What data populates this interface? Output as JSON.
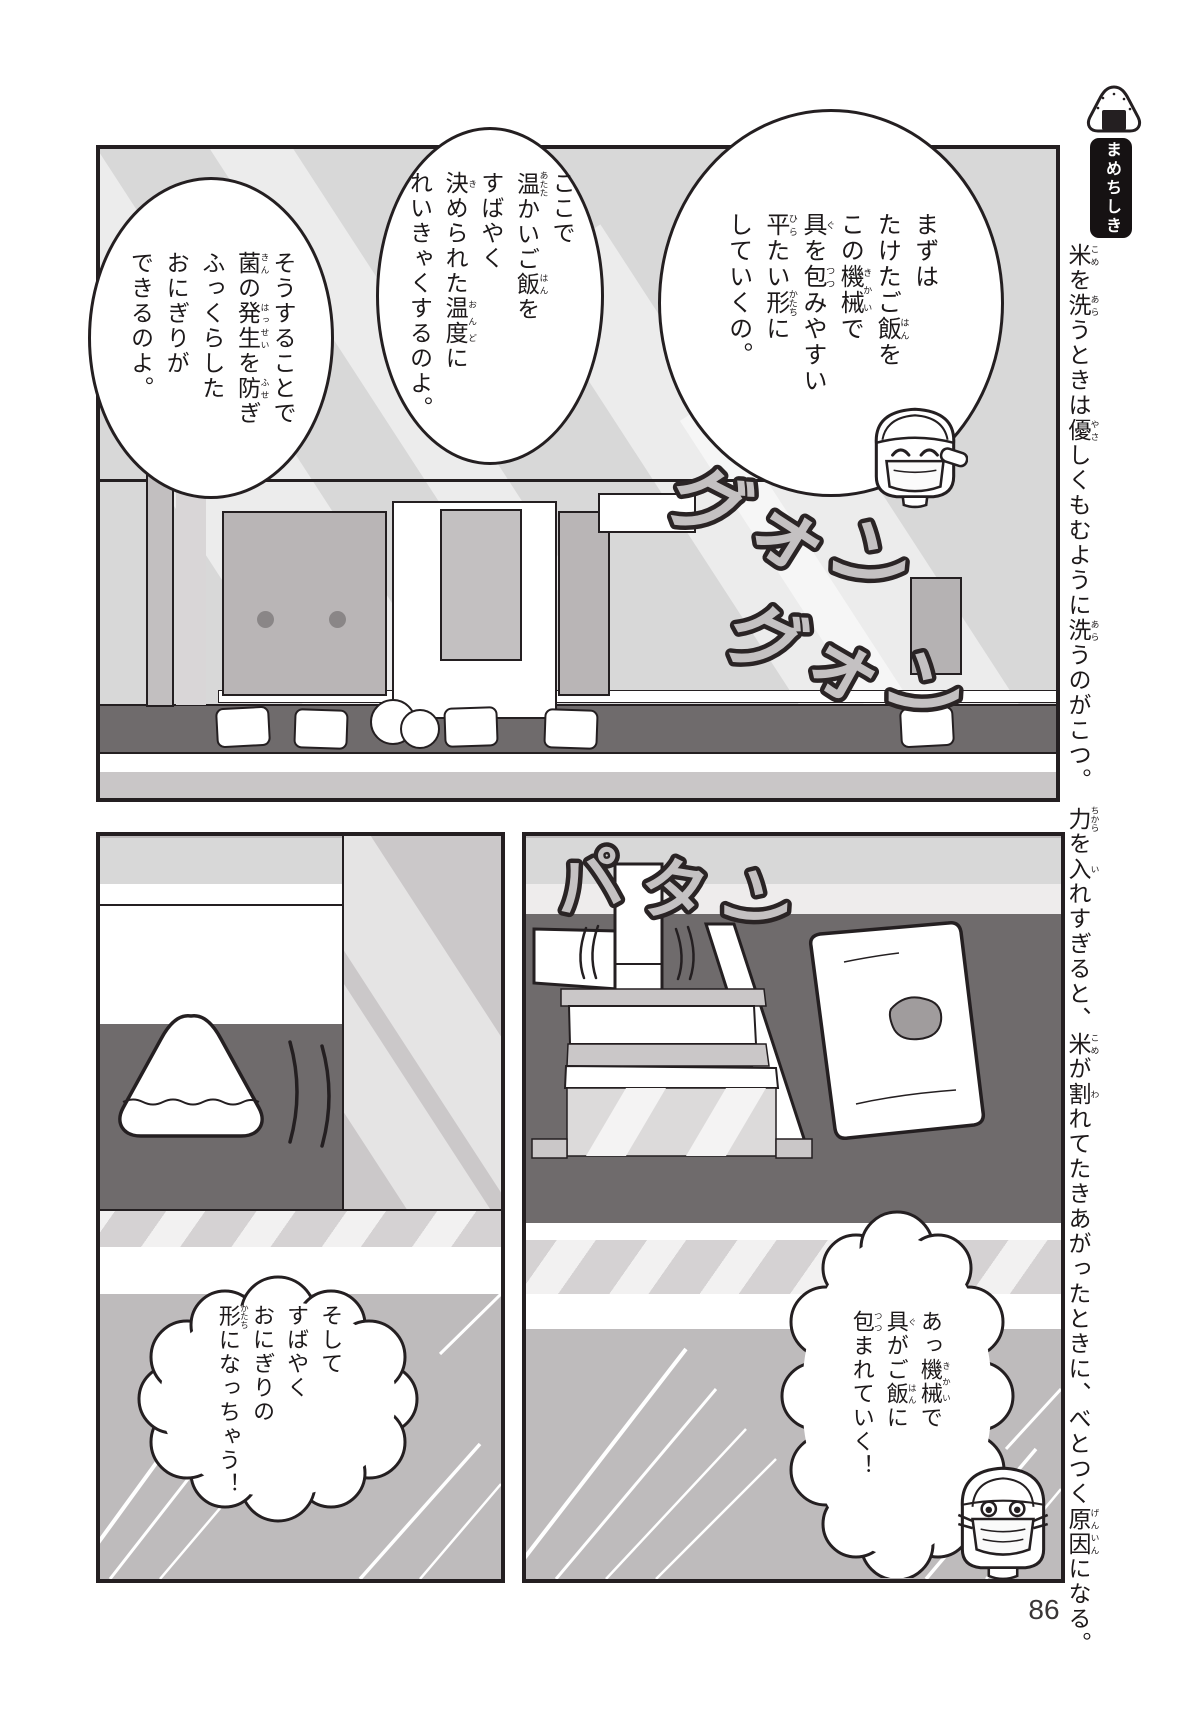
{
  "page": {
    "number": "86"
  },
  "sidebar": {
    "badge": "まめちしき",
    "note": [
      {
        "t": "米",
        "r": "こめ"
      },
      {
        "t": "を"
      },
      {
        "t": "洗",
        "r": "あら"
      },
      {
        "t": "うときは"
      },
      {
        "t": "優",
        "r": "やさ"
      },
      {
        "t": "しくもむように"
      },
      {
        "t": "洗",
        "r": "あら"
      },
      {
        "t": "うのがこつ。　"
      },
      {
        "t": "力",
        "r": "ちから"
      },
      {
        "t": "を"
      },
      {
        "t": "入",
        "r": "い"
      },
      {
        "t": "れすぎると、"
      },
      {
        "t": "米",
        "r": "こめ"
      },
      {
        "t": "が"
      },
      {
        "t": "割",
        "r": "わ"
      },
      {
        "t": "れてたきあがったときに、べとつく"
      },
      {
        "t": "原因",
        "r": "げんいん"
      },
      {
        "t": "になる。"
      }
    ]
  },
  "panel_factory": {
    "bubble_first": [
      {
        "t": "まずは"
      },
      {
        "br": true
      },
      {
        "t": "たけたご"
      },
      {
        "t": "飯",
        "r": "はん"
      },
      {
        "t": "を"
      },
      {
        "br": true
      },
      {
        "t": "この"
      },
      {
        "t": "機械",
        "r": "きかい"
      },
      {
        "t": "で"
      },
      {
        "br": true
      },
      {
        "t": "具",
        "r": "ぐ"
      },
      {
        "t": "を"
      },
      {
        "t": "包",
        "r": "つつ"
      },
      {
        "t": "みやすい"
      },
      {
        "br": true
      },
      {
        "t": "平",
        "r": "ひら"
      },
      {
        "t": "たい"
      },
      {
        "t": "形",
        "r": "かたち"
      },
      {
        "t": "に"
      },
      {
        "br": true
      },
      {
        "t": "していくの。"
      }
    ],
    "bubble_second": [
      {
        "t": "ここで"
      },
      {
        "br": true
      },
      {
        "t": "温",
        "r": "あたた"
      },
      {
        "t": "かいご"
      },
      {
        "t": "飯",
        "r": "はん"
      },
      {
        "t": "を"
      },
      {
        "br": true
      },
      {
        "t": "すばやく"
      },
      {
        "br": true
      },
      {
        "t": "決",
        "r": "き"
      },
      {
        "t": "められた"
      },
      {
        "t": "温度",
        "r": "おんど"
      },
      {
        "t": "に"
      },
      {
        "br": true
      },
      {
        "t": "れいきゃくするのよ。"
      }
    ],
    "bubble_third": [
      {
        "t": "そうすることで"
      },
      {
        "br": true
      },
      {
        "t": "菌",
        "r": "きん"
      },
      {
        "t": "の"
      },
      {
        "t": "発生",
        "r": "はっせい"
      },
      {
        "t": "を"
      },
      {
        "t": "防",
        "r": "ふせ"
      },
      {
        "t": "ぎ"
      },
      {
        "br": true
      },
      {
        "t": "ふっくらした"
      },
      {
        "br": true
      },
      {
        "t": "おにぎりが"
      },
      {
        "br": true
      },
      {
        "t": "できるのよ。"
      }
    ],
    "sfx_a": "グォン",
    "sfx_b": "グォン"
  },
  "panel_onigiri": {
    "bubble": [
      {
        "t": "そして"
      },
      {
        "br": true
      },
      {
        "t": "すばやく"
      },
      {
        "br": true
      },
      {
        "t": "おにぎりの"
      },
      {
        "br": true
      },
      {
        "t": "形",
        "r": "かたち"
      },
      {
        "t": "になっちゃう！"
      }
    ]
  },
  "panel_press": {
    "sfx": "パタン",
    "bubble": [
      {
        "t": "あっ"
      },
      {
        "t": "機械",
        "r": "きかい"
      },
      {
        "t": "で"
      },
      {
        "br": true
      },
      {
        "t": "具",
        "r": "ぐ"
      },
      {
        "t": "がご"
      },
      {
        "t": "飯",
        "r": "はん"
      },
      {
        "t": "に"
      },
      {
        "br": true
      },
      {
        "t": "包",
        "r": "つつ"
      },
      {
        "t": "まれていく！"
      }
    ]
  },
  "colors": {
    "ink": "#241f21",
    "light_gray": "#d8d8d8",
    "mid_gray": "#b9b5b6",
    "dark_gray": "#6f6b6c",
    "sfx_fill": "#c4c1c2",
    "page_bg": "#ffffff"
  }
}
